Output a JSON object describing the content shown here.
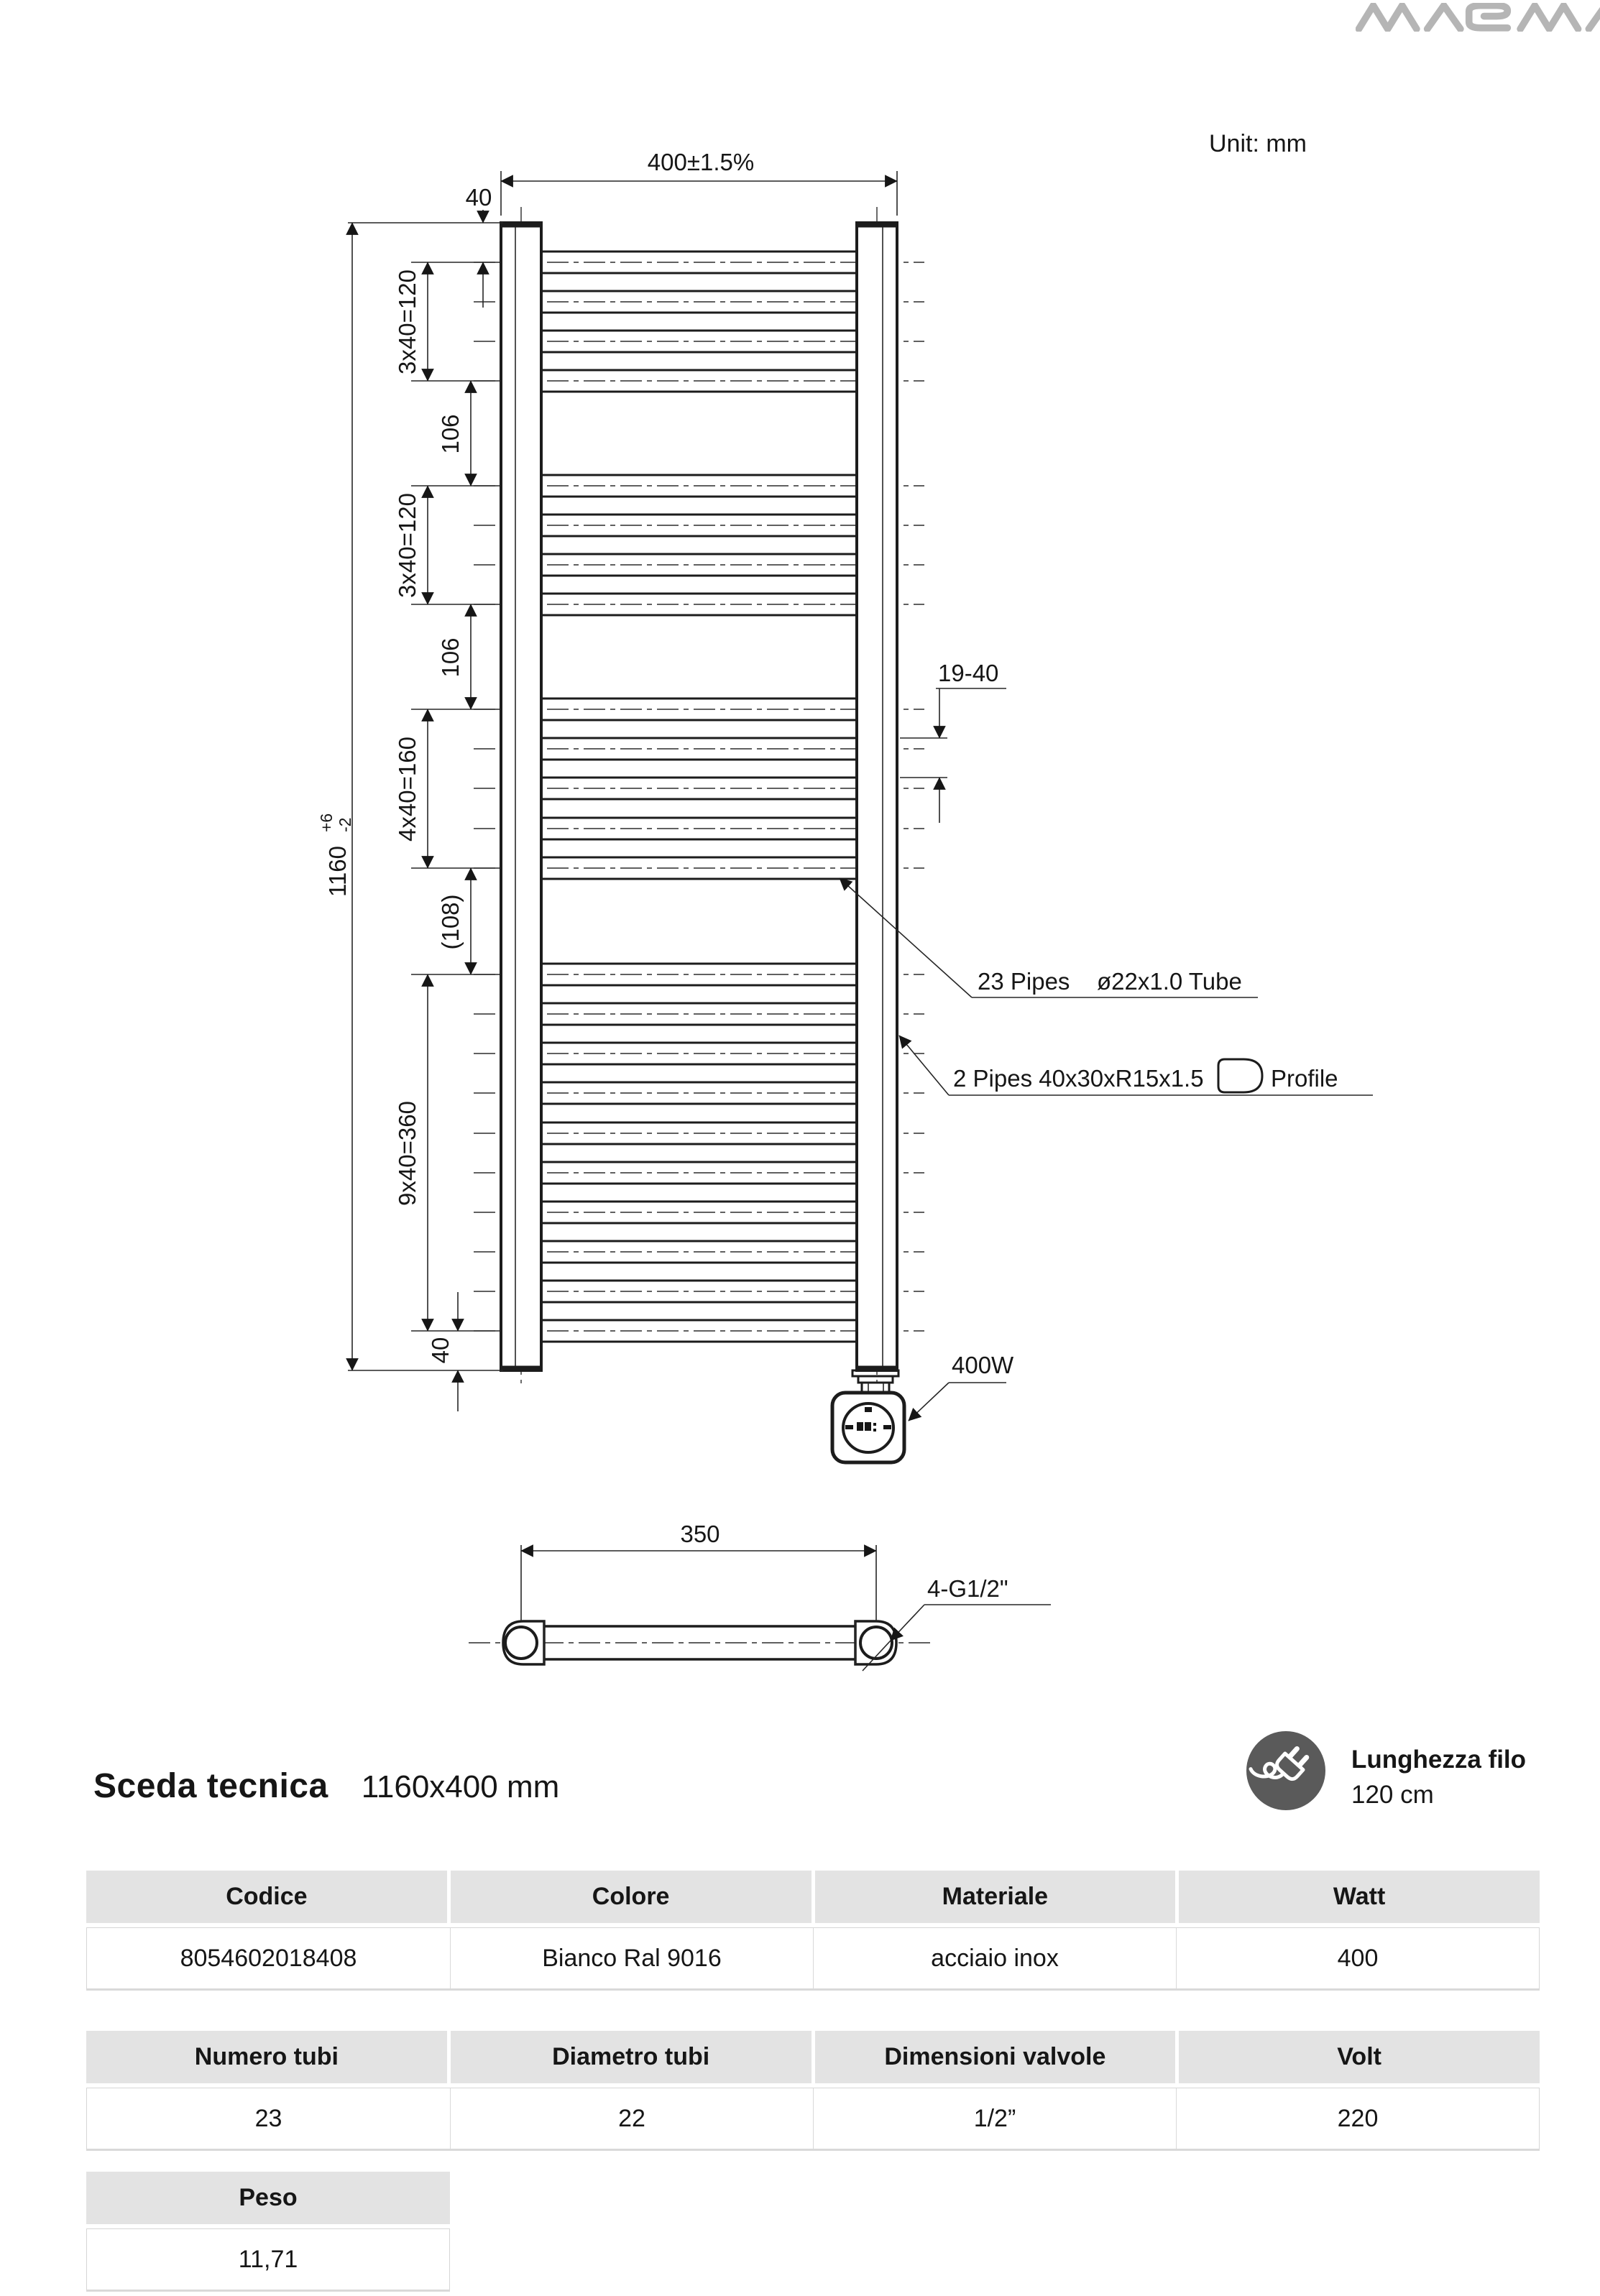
{
  "brand": {
    "logo_text": "MAGMA"
  },
  "drawing": {
    "unit_note": "Unit: mm",
    "dims": {
      "width": "400±1.5%",
      "top_offset": "40",
      "group1": "3x40=120",
      "gap1": "106",
      "group2": "3x40=120",
      "gap2": "106",
      "group3": "4x40=160",
      "gap3": "(108)",
      "group4": "9x40=360",
      "bottom_offset": "40",
      "overall_height": "1160",
      "overall_tol_plus": "+6",
      "overall_tol_minus": "-2",
      "bracket_range": "19-40",
      "port_span": "350"
    },
    "callouts": {
      "pipes_count": "23 Pipes",
      "pipes_tube": "ø22x1.0 Tube",
      "profile_pipes": "2 Pipes 40x30xR15x1.5",
      "profile_word": "Profile",
      "power": "400W",
      "valve_threads": "4-G1/2\""
    }
  },
  "title": {
    "heading": "Sceda tecnica",
    "size": "1160x400 mm"
  },
  "cable": {
    "label": "Lunghezza filo",
    "value": "120 cm"
  },
  "tables": {
    "specs": {
      "headers": [
        "Codice",
        "Colore",
        "Materiale",
        "Watt"
      ],
      "row": [
        "8054602018408",
        "Bianco Ral 9016",
        "acciaio inox",
        "400"
      ]
    },
    "details": {
      "headers": [
        "Numero tubi",
        "Diametro tubi",
        "Dimensioni valvole",
        "Volt"
      ],
      "row": [
        "23",
        "22",
        "1/2”",
        "220"
      ]
    },
    "weight": {
      "headers": [
        "Peso"
      ],
      "row": [
        "11,71"
      ]
    }
  }
}
